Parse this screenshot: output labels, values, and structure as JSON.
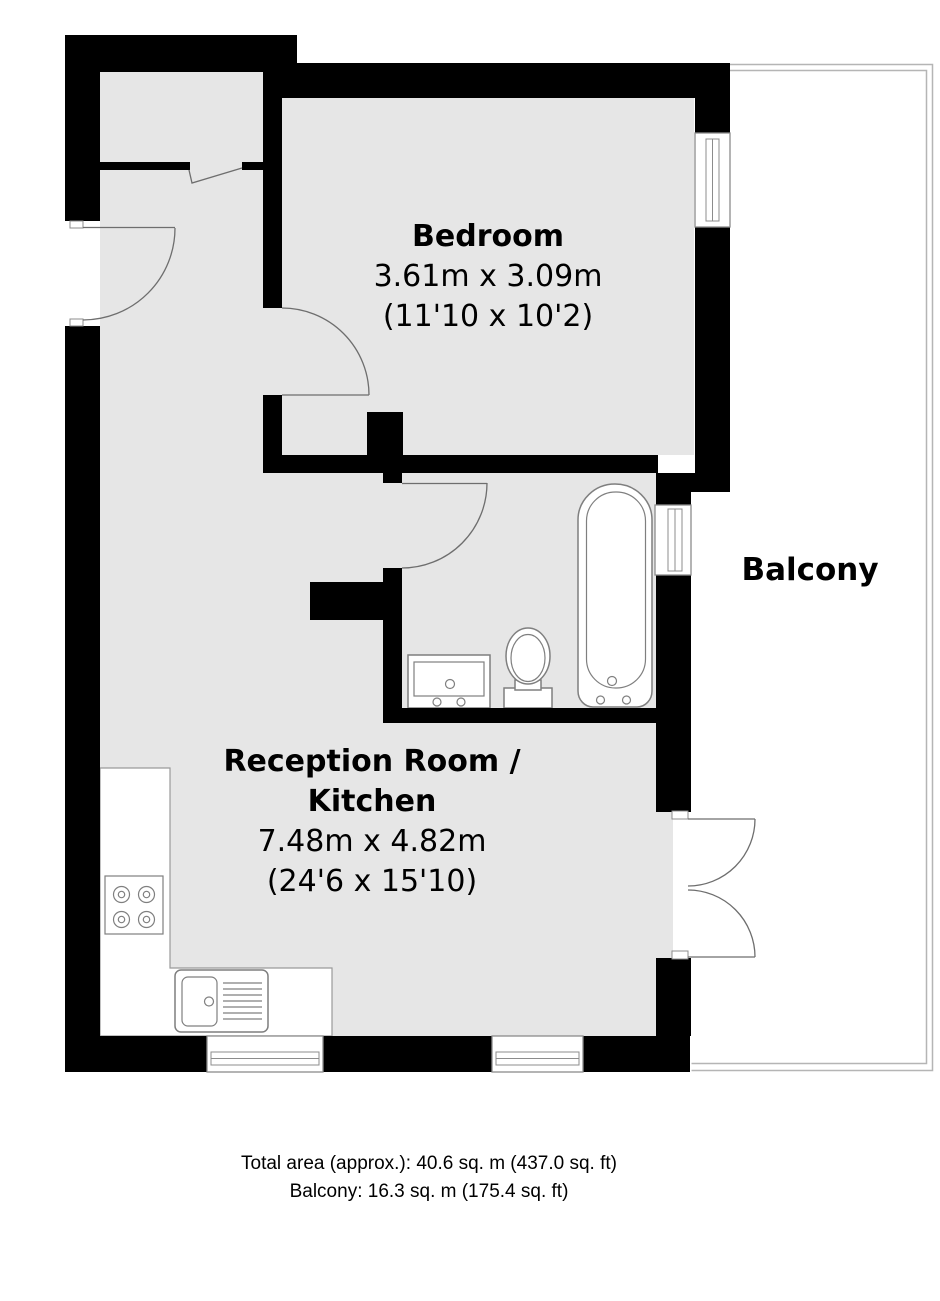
{
  "title": "Floor plan",
  "rooms": {
    "bedroom": {
      "name": "Bedroom",
      "dims_metric": "3.61m x 3.09m",
      "dims_imperial": "(11'10 x 10'2)"
    },
    "reception": {
      "name_line1": "Reception Room /",
      "name_line2": "Kitchen",
      "dims_metric": "7.48m x 4.82m",
      "dims_imperial": "(24'6 x 15'10)"
    },
    "balcony": {
      "name": "Balcony"
    }
  },
  "footer": {
    "total_area": "Total area (approx.): 40.6 sq. m (437.0 sq. ft)",
    "balcony_area": "Balcony: 16.3 sq. m (175.4 sq. ft)"
  },
  "colors": {
    "wall": "#000000",
    "floor": "#e6e6e6",
    "fixture_outline": "#7f7f7f",
    "balcony_outline": "#b5b5b5",
    "door_line": "#6e6e6e",
    "text": "#000000",
    "background": "#ffffff"
  }
}
